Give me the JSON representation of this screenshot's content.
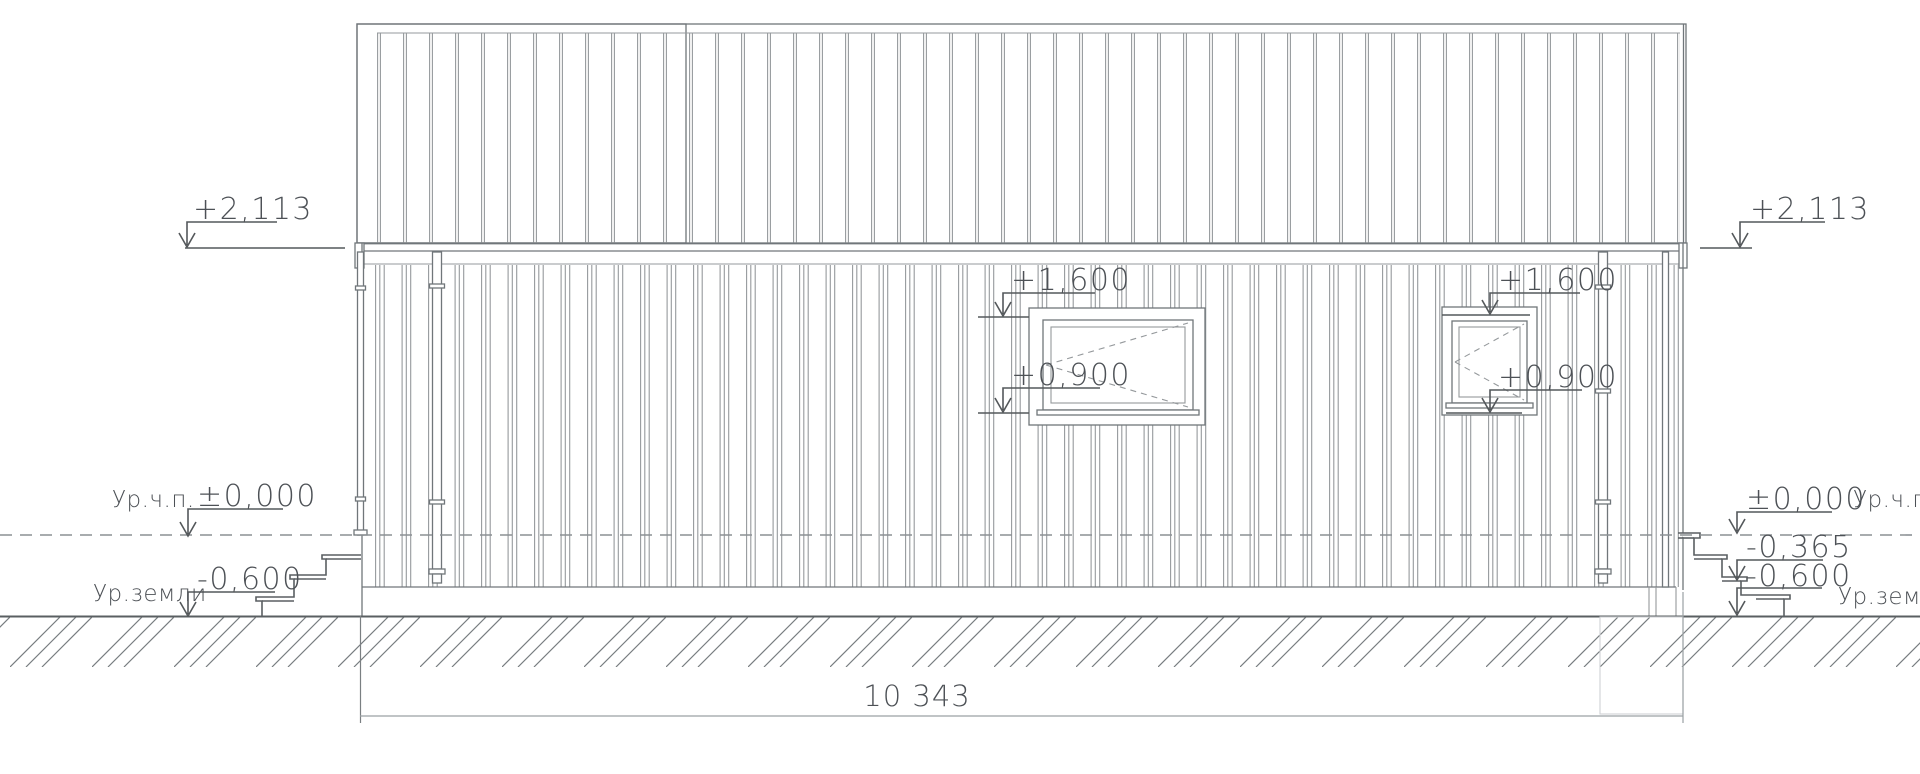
{
  "palette": {
    "background": "#ffffff",
    "line_main": "#70767a",
    "line_thin": "#95999c",
    "line_faint": "#cfd2d4",
    "line_dark": "#5a5f62",
    "line_dim": "#9aa0a3",
    "line_dash": "#8b9094",
    "ink": "#4d5156"
  },
  "markers": {
    "eave_left": {
      "value": "+2,113"
    },
    "eave_right": {
      "value": "+2,113"
    },
    "window1_head": {
      "value": "+1,600"
    },
    "window1_sill": {
      "value": "+0,900"
    },
    "window2_head": {
      "value": "+1,600"
    },
    "window2_sill": {
      "value": "+0,900"
    },
    "floor_left": {
      "value": "±0,000"
    },
    "floor_right": {
      "value": "±0,000"
    },
    "porch_right": {
      "value": "-0,365"
    },
    "ground_left": {
      "value": "-0,600"
    },
    "ground_right": {
      "value": "-0,600"
    }
  },
  "labels": {
    "floor_left": "Ур.ч.п.",
    "floor_right": "Ур.ч.п.",
    "ground_left": "Ур.земли",
    "ground_right": "Ур.земли"
  },
  "dimension": {
    "overall_width": "10 343"
  }
}
